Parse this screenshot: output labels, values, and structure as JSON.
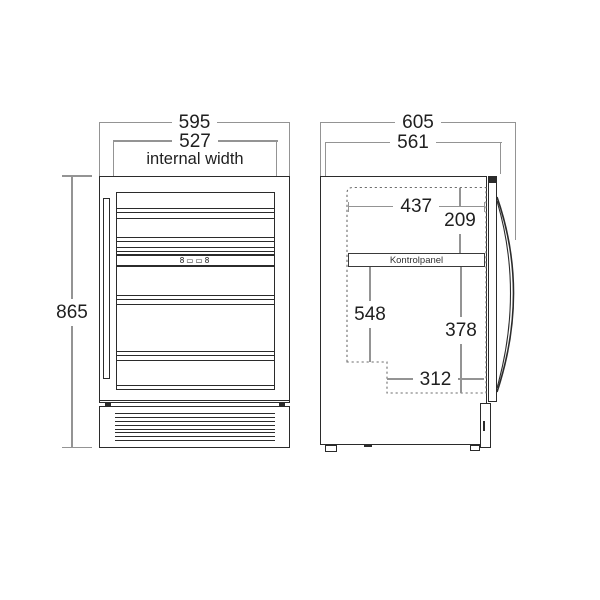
{
  "front_view": {
    "dim_width_total": "595",
    "dim_width_internal": "527",
    "dim_width_internal_caption": "internal width",
    "dim_height_total": "865",
    "display_panel_text": "8▭▭8"
  },
  "side_view": {
    "dim_depth_total": "605",
    "dim_depth_body": "561",
    "dim_internal_depth_top": "437",
    "dim_top_to_panel": "209",
    "control_panel_label": "Kontrolpanel",
    "dim_panel_to_bottom_rear": "548",
    "dim_panel_to_recess": "378",
    "dim_recess_depth": "312"
  }
}
